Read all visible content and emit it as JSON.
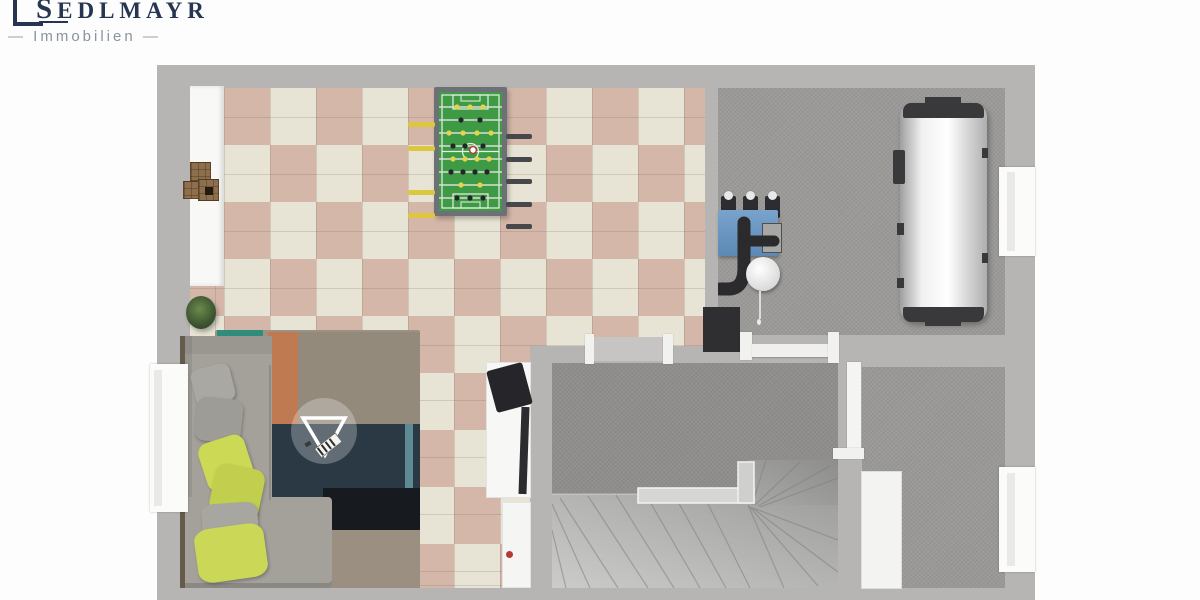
{
  "brand": {
    "name": "SEDLMAYR",
    "tagline": "Immobilien",
    "dash": "—",
    "name_color": "#263652",
    "tagline_color": "#8b92a0"
  },
  "floor_plan": {
    "view": "3d-top-down-floor-plan",
    "watermark": "triangle-logo-badge",
    "colors": {
      "wall": "#b6b5b3",
      "tile_cream": "#e8e4d5",
      "tile_rose": "#d4b7a8",
      "concrete_light": "#9b9a98",
      "concrete_dark": "#8f8e8c",
      "foosball_green": "#3e9a44",
      "boiler_blue": "#6f9ac4",
      "sofa_gray": "#a4a19b",
      "cushion_yellow": "#ccd955",
      "rug_navy": "#2b3944",
      "rug_orange": "#bf7a52",
      "rug_teal": "#2f8d7c"
    },
    "rooms": [
      {
        "id": "party-room",
        "floor": "checkerboard-tiles",
        "contents": [
          "counter",
          "wooden-crates",
          "potted-plant",
          "foosball-table",
          "corner-sofa",
          "cushions",
          "patchwork-rug",
          "tv-sideboard",
          "window"
        ]
      },
      {
        "id": "technical-room",
        "floor": "concrete",
        "contents": [
          "heating-unit",
          "expansion-vessels",
          "pipes",
          "round-tank",
          "hot-water-cylinder",
          "window",
          "door-mat"
        ]
      },
      {
        "id": "stair-hall",
        "floor": "concrete",
        "contents": [
          "winder-staircase",
          "handrail",
          "door-openings"
        ]
      },
      {
        "id": "storage-room",
        "floor": "concrete",
        "contents": [
          "door-leaf",
          "window"
        ]
      }
    ]
  }
}
